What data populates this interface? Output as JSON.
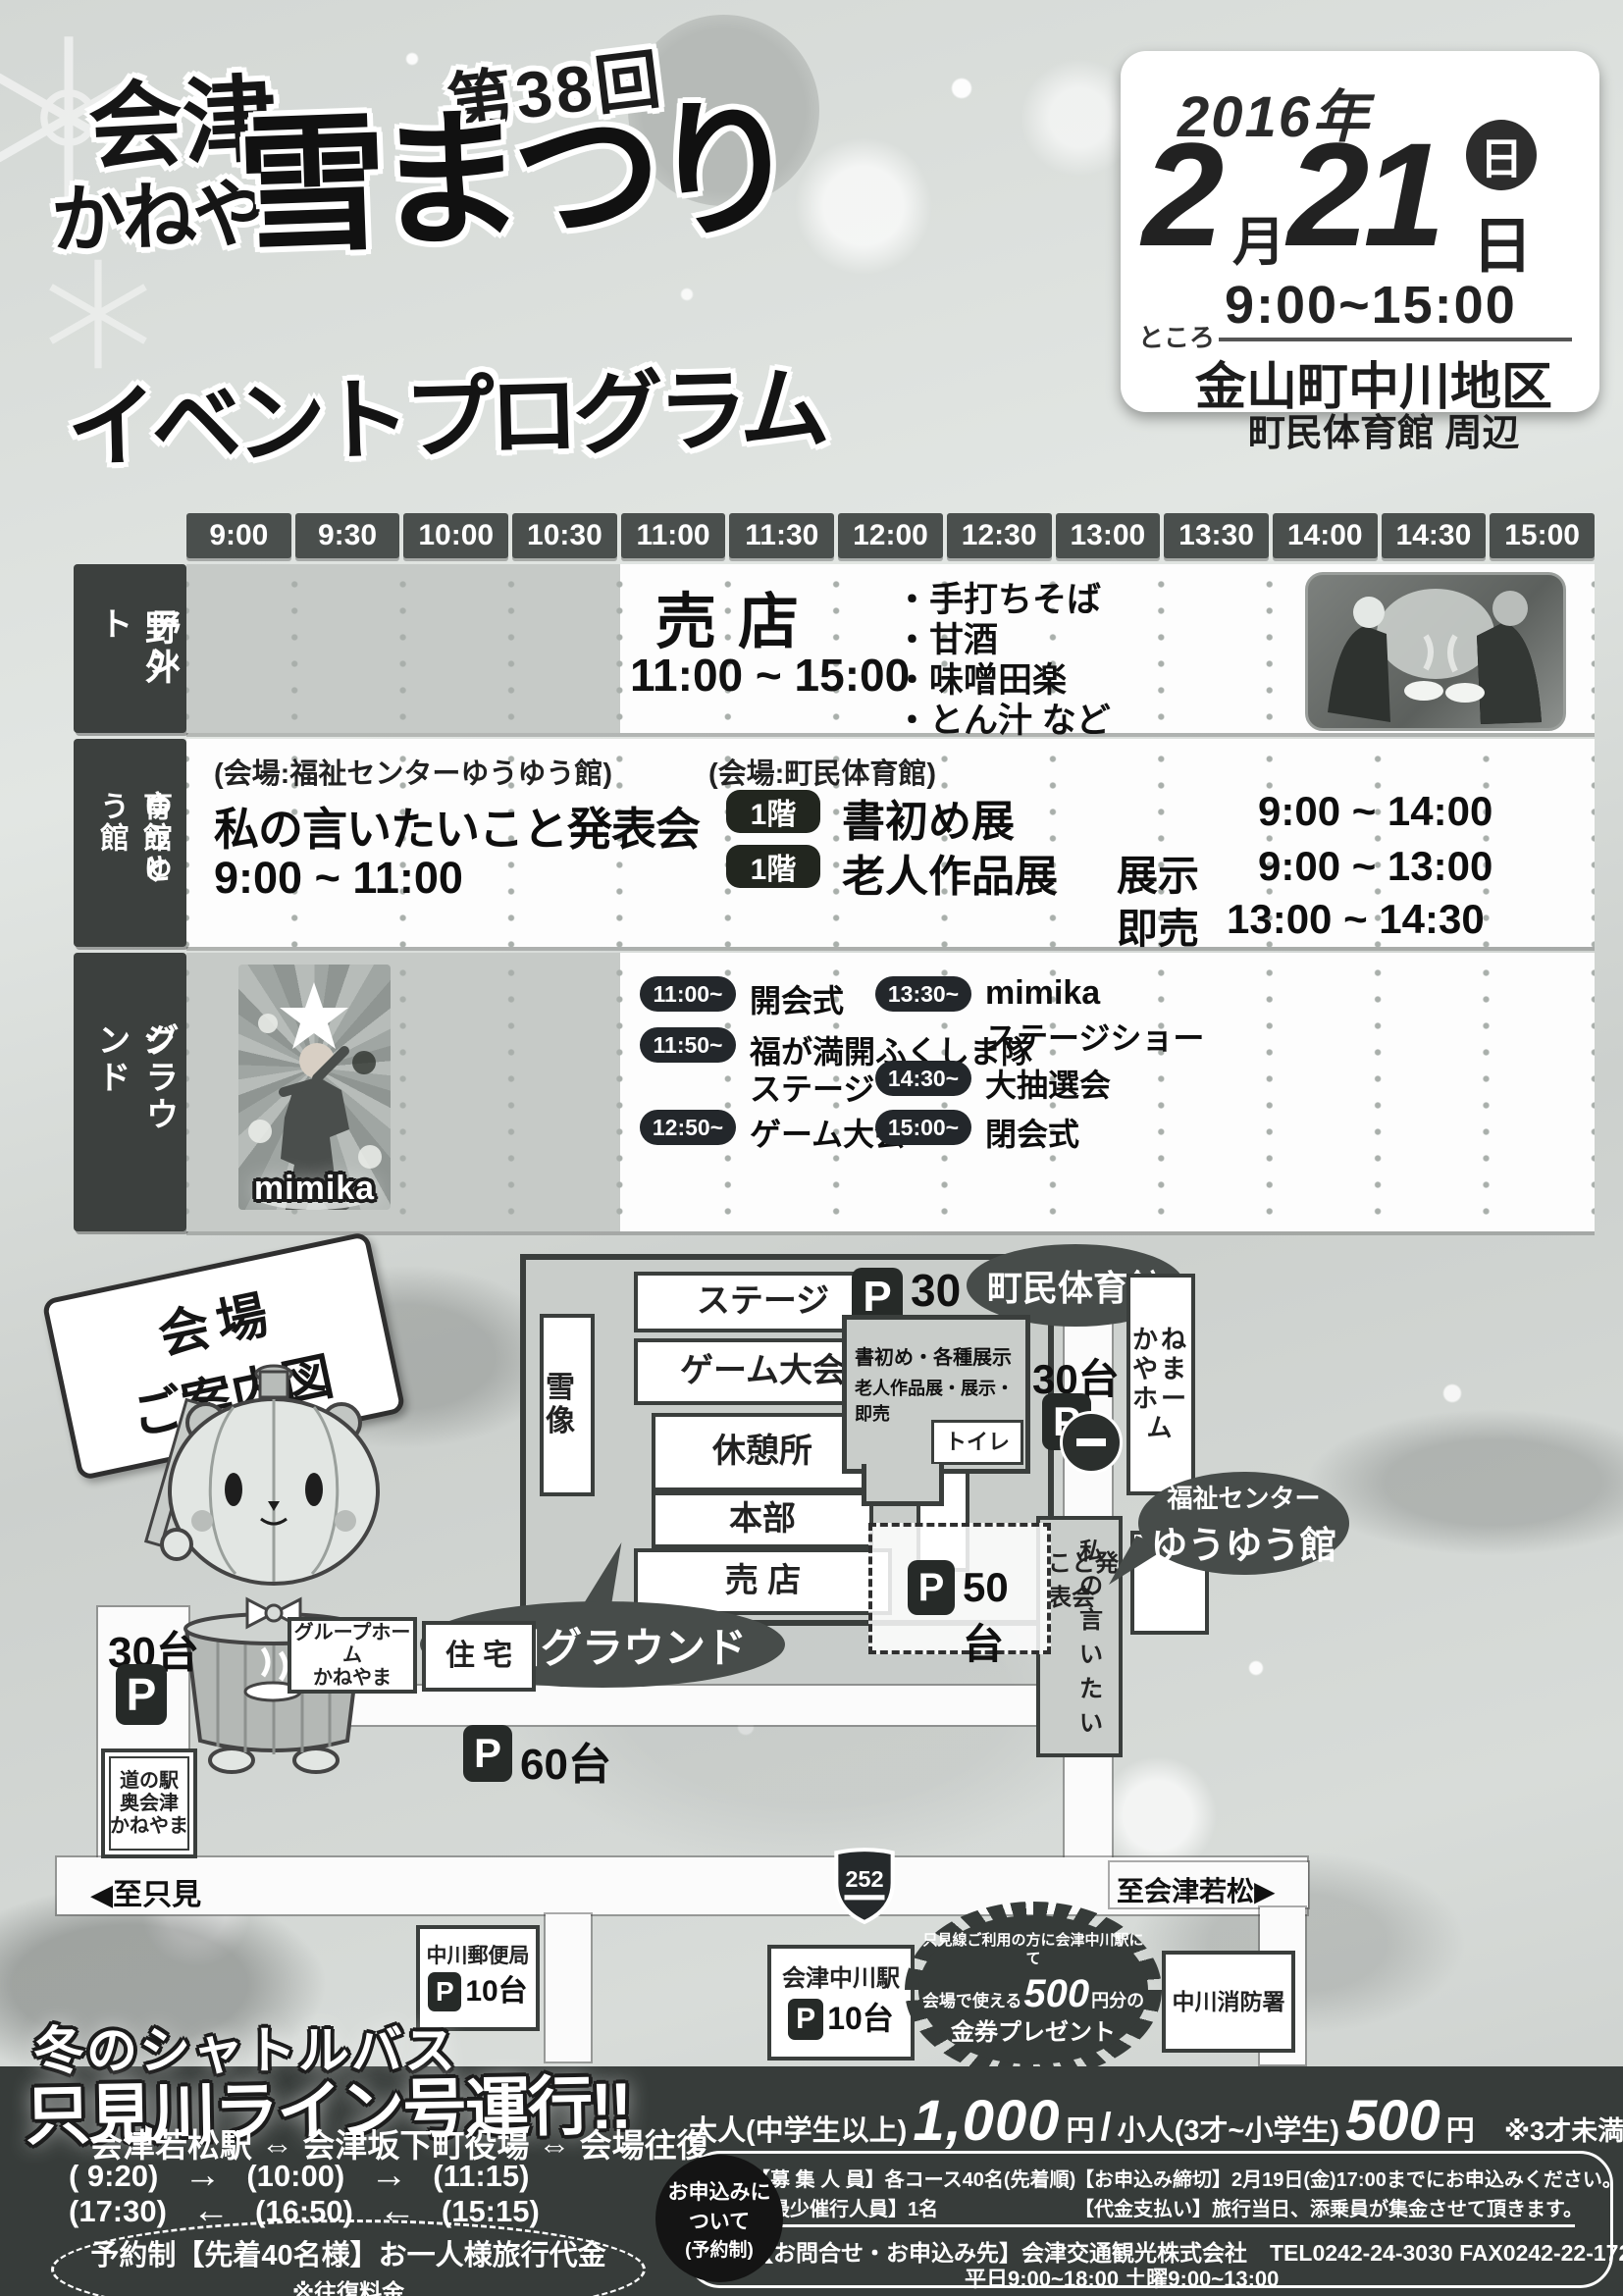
{
  "header": {
    "edition": "第38回",
    "title_top": "会津",
    "title_mid": "かねやま",
    "title_main": "雪まつり",
    "subtitle": "イベントプログラム",
    "date_box": {
      "year": "2016年",
      "month": "2",
      "month_unit": "月",
      "day": "21",
      "weekday": "日",
      "day_unit": "日",
      "time": "9:00~15:00",
      "place_label": "ところ",
      "place_main": "金山町中川地区",
      "place_sub": "町民体育館 周辺"
    }
  },
  "schedule": {
    "times": [
      "9:00",
      "9:30",
      "10:00",
      "10:30",
      "11:00",
      "11:30",
      "12:00",
      "12:30",
      "13:00",
      "13:30",
      "14:00",
      "14:30",
      "15:00"
    ],
    "row1": {
      "label_a": "野外",
      "label_b": "テント",
      "event": "売店",
      "time": "11:00 ~ 15:00",
      "items": [
        "・手打ちそば",
        "・甘酒",
        "・味噌田楽",
        "・とん汁  など"
      ]
    },
    "row2": {
      "label_a": "町民体育館と",
      "label_b": "ゆうゆう館",
      "left_venue": "(会場:福祉センターゆうゆう館)",
      "left_event": "私の言いたいこと発表会",
      "left_time": "9:00 ~ 11:00",
      "right_venue": "(会場:町民体育館)",
      "floor_badge": "1階",
      "e1_name": "書初め展",
      "e1_time": "9:00 ~ 14:00",
      "e2_name": "老人作品展",
      "e2_phase": "展示",
      "e2_time": "9:00 ~ 13:00",
      "e3_phase": "即売",
      "e3_time": "13:00 ~ 14:30"
    },
    "row3": {
      "label_a": "ステージ",
      "label_b": "グラウンド",
      "photo_caption": "mimika",
      "l1_time": "11:00~",
      "l1_name": "開会式",
      "l2_time": "11:50~",
      "l2_name": "福が満開ふくしま隊",
      "l2_name2": "ステージ",
      "l3_time": "12:50~",
      "l3_name": "ゲーム大会",
      "r1_time": "13:30~",
      "r1_name": "mimika",
      "r1_name2": "ステージショー",
      "r2_time": "14:30~",
      "r2_name": "大抽選会",
      "r3_time": "15:00~",
      "r3_name": "閉会式"
    }
  },
  "map": {
    "sign_line1": "会場",
    "sign_line2": "ご案内図",
    "ground_balloon": "中川グラウンド",
    "snow_statue": "雪像",
    "stage": "ステージ",
    "game": "ゲーム大会",
    "rest": "休憩所",
    "hq": "本部",
    "shop_bottom": "売 店",
    "shop_right": "売店",
    "p_letter": "P",
    "p30_top": "30台",
    "p30_mid": "30台",
    "p30_left": "30台",
    "p50": "50台",
    "p60": "60台",
    "p10_post": "10台",
    "p10_sta": "10台",
    "gym_balloon": "町民体育館",
    "gym_line1": "書初め・各種展示",
    "gym_line2": "老人作品展・展示・即売",
    "toilet": "トイレ",
    "kaneyama_home": "かねやまホーム",
    "fukushi_line1": "福祉センター",
    "fukushi_line2": "ゆうゆう館",
    "watashi_a": "私の言いたい",
    "watashi_b": "こと発表会",
    "group_home_1": "グループホーム",
    "group_home_2": "かねやま",
    "jutaku": "住 宅",
    "michinoeki_1": "道の駅",
    "michinoeki_2": "奥会津",
    "michinoeki_3": "かねやま",
    "to_tadami": "◀至只見",
    "route_number": "252",
    "to_wakamatsu": "至会津若松▶",
    "post_office": "中川郵便局",
    "station": "会津中川駅",
    "burst_line1": "只見線ご利用の方に会津中川駅にて",
    "burst_line2a": "会場で使える",
    "burst_line2b": "500",
    "burst_line2c": "円分の",
    "burst_line3": "金券プレゼント",
    "fire_station": "中川消防署"
  },
  "shuttle": {
    "title1": "冬のシャトルバス",
    "title2": "只見川ライン号運行!!",
    "route": "会津若松駅 ⇔ 会津坂下町役場 ⇔ 会場往復",
    "t_out1": "( 9:20)",
    "t_out2": "(10:00)",
    "t_out3": "(11:15)",
    "t_back1": "(17:30)",
    "t_back2": "(16:50)",
    "t_back3": "(15:15)",
    "arrow_r": "→",
    "arrow_l": "←",
    "reserve": "予約制【先着40名様】お一人様旅行代金",
    "note": "※往復料金",
    "price": {
      "adult_label": "大人(中学生以上)",
      "adult_price": "1,000",
      "yen1": "円",
      "slash": "/",
      "child_label": "小人(3才~小学生)",
      "child_price": "500",
      "yen2": "円",
      "free_note": "※3才未満は無料"
    },
    "info": {
      "badge1": "お申込みに",
      "badge2": "ついて",
      "badge3": "(予約制)",
      "r1a": "【募 集 人 員】各コース40名(先着順)",
      "r1b": "【お申込み締切】2月19日(金)17:00までにお申込みください。",
      "r2a": "【最少催行人員】1名",
      "r2b": "【代金支払い】旅行当日、添乗員が集金させて頂きます。",
      "r3": "【お問合せ・お申込み先】会津交通観光株式会社　TEL0242-24-3030  FAX0242-22-1723",
      "r4": "平日9:00~18:00  土曜9:00~13:00"
    }
  }
}
